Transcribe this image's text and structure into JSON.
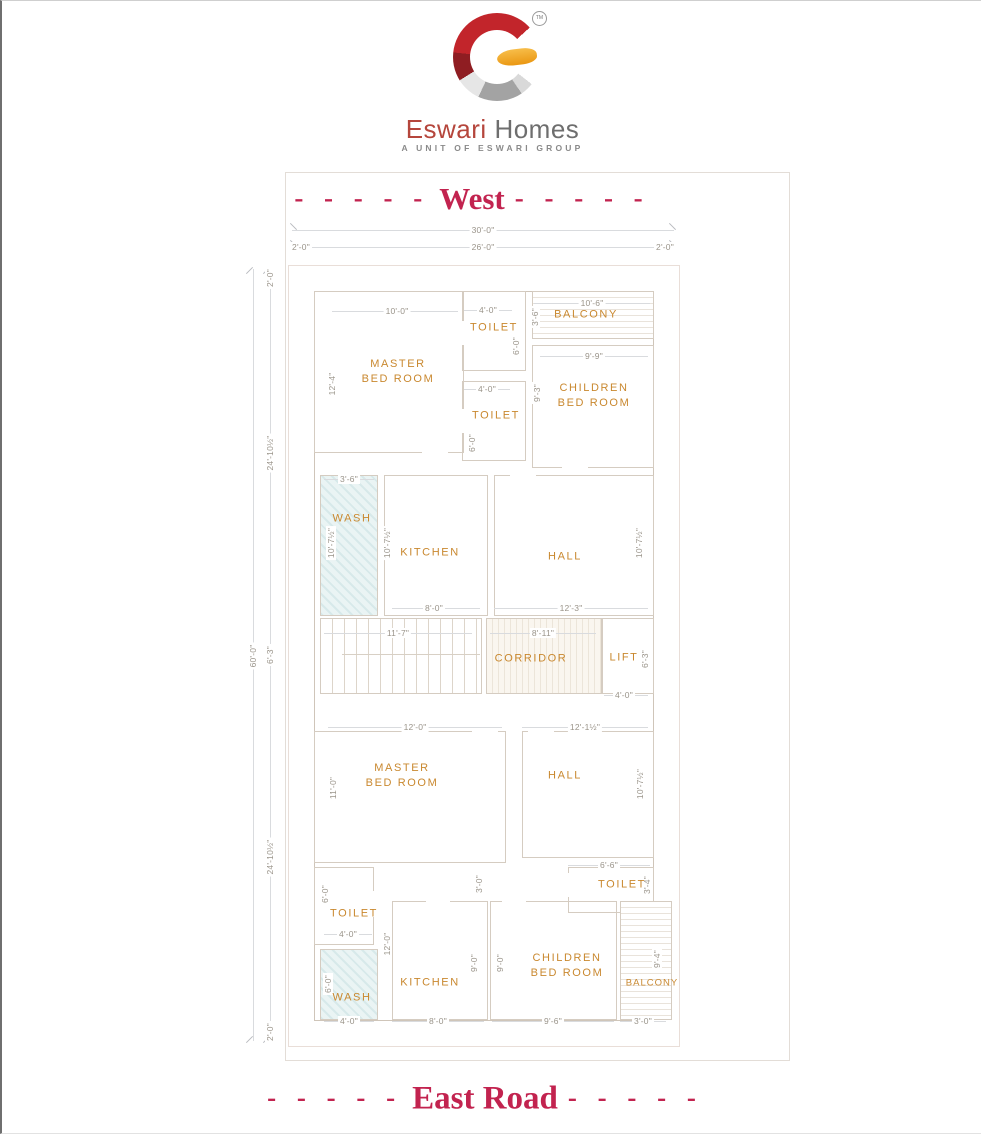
{
  "brand": {
    "tm": "TM",
    "name_primary": "Eswari",
    "name_secondary": "Homes",
    "tagline": "A UNIT OF ESWARI GROUP",
    "colors": {
      "logo_red": "#c2252b",
      "logo_yellow": "#f0a32a",
      "logo_silver": "#ababab",
      "name_primary": "#b5463c",
      "name_secondary": "#6e6e6e"
    }
  },
  "plan": {
    "title_top": "West",
    "title_bottom": "East Road",
    "dashes": "- - - - -",
    "colors": {
      "title": "#c2234f",
      "room_label": "#c9882f",
      "dimension_text": "#9a948a",
      "wall_line": "#cfc5b9",
      "wash_fill": "#eaf4f4"
    },
    "rooms": {
      "master": {
        "l1": "MASTER",
        "l2": "BED ROOM"
      },
      "children": {
        "l1": "CHILDREN",
        "l2": "BED ROOM"
      },
      "toilet": "TOILET",
      "balcony": "BALCONY",
      "wash": "WASH",
      "kitchen": "KITCHEN",
      "hall": "HALL",
      "corridor": "CORRIDOR",
      "lift": "LIFT"
    },
    "dims": {
      "ft30": "30'-0\"",
      "ft26": "26'-0\"",
      "ft2": "2'-0\"",
      "ft60": "60'-0\"",
      "ft24_10h": "24'-10½\"",
      "ft6_3": "6'-3\"",
      "ft10": "10'-0\"",
      "ft12_4": "12'-4\"",
      "ft4": "4'-0\"",
      "ft6": "6'-0\"",
      "ft10_6": "10'-6\"",
      "ft3_6": "3'-6\"",
      "ft9_9": "9'-9\"",
      "ft9_3": "9'-3\"",
      "ft10_7h": "10'-7½\"",
      "ft8": "8'-0\"",
      "ft12_3": "12'-3\"",
      "ft11_7": "11'-7\"",
      "ft8_11": "8'-11\"",
      "ft12": "12'-0\"",
      "ft12_1h": "12'-1½\"",
      "ft11": "11'-0\"",
      "ft6_6": "6'-6\"",
      "ft3_4": "3'-4\"",
      "ft3": "3'-0\"",
      "ft9": "9'-0\"",
      "ft9_6": "9'-6\"",
      "ft9_4": "9'-4\""
    }
  }
}
